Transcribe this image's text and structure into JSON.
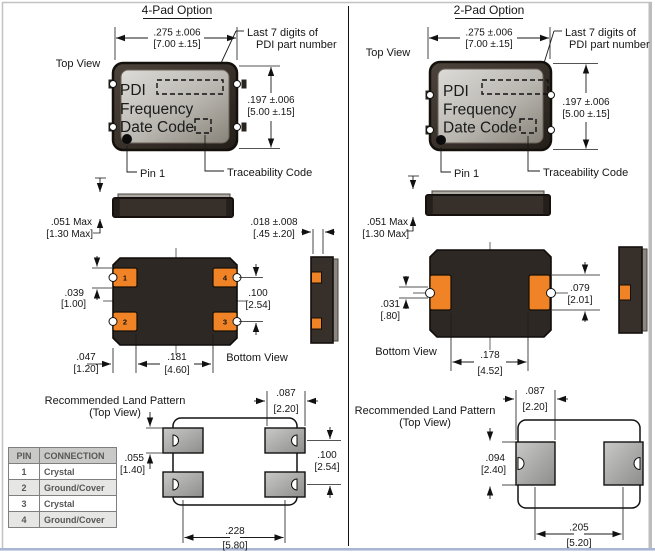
{
  "left": {
    "title": "4-Pad Option",
    "top_view_label": "Top View",
    "callout_line1": "Last 7 digits of",
    "callout_line2": "PDI part number",
    "package_text": {
      "line1": "PDI",
      "line2": "Frequency",
      "line3": "Date Code"
    },
    "pin1_label": "Pin 1",
    "traceability_label": "Traceability Code",
    "bottom_view_label": "Bottom View",
    "land_pattern_line1": "Recommended Land Pattern",
    "land_pattern_line2": "(Top View)",
    "pad_numbers": {
      "tl": "1",
      "tr": "4",
      "bl": "2",
      "br": "3"
    },
    "dims": {
      "width_in": ".275 ±.006",
      "width_mm": "[7.00 ±.15]",
      "height_in": ".197 ±.006",
      "height_mm": "[5.00 ±.15]",
      "thickness_in": ".051 Max",
      "thickness_mm": "[1.30 Max]",
      "pad_wrap_in": ".018 ±.008",
      "pad_wrap_mm": "[.45 ±.20]",
      "pad_height_in": ".039",
      "pad_height_mm": "[1.00]",
      "pad_pitch_in": ".100",
      "pad_pitch_mm": "[2.54]",
      "pad_edge_in": ".047",
      "pad_edge_mm": "[1.20]",
      "pad_span_in": ".181",
      "pad_span_mm": "[4.60]",
      "land_width_in": ".087",
      "land_width_mm": "[2.20]",
      "land_height_in": ".055",
      "land_height_mm": "[1.40]",
      "land_pitch_in": ".100",
      "land_pitch_mm": "[2.54]",
      "land_span_in": ".228",
      "land_span_mm": "[5.80]"
    }
  },
  "right": {
    "title": "2-Pad Option",
    "top_view_label": "Top View",
    "callout_line1": "Last 7 digits of",
    "callout_line2": "PDI part number",
    "package_text": {
      "line1": "PDI",
      "line2": "Frequency",
      "line3": "Date Code"
    },
    "pin1_label": "Pin 1",
    "traceability_label": "Traceability Code",
    "bottom_view_label": "Bottom View",
    "land_pattern_line1": "Recommended Land Pattern",
    "land_pattern_line2": "(Top View)",
    "dims": {
      "width_in": ".275 ±.006",
      "width_mm": "[7.00 ±.15]",
      "height_in": ".197 ±.006",
      "height_mm": "[5.00 ±.15]",
      "thickness_in": ".051 Max",
      "thickness_mm": "[1.30 Max]",
      "notch_in": ".031",
      "notch_mm": "[.80]",
      "pad_height_in": ".079",
      "pad_height_mm": "[2.01]",
      "pad_span_in": ".178",
      "pad_span_mm": "[4.52]",
      "land_width_in": ".087",
      "land_width_mm": "[2.20]",
      "land_height_in": ".094",
      "land_height_mm": "[2.40]",
      "land_span_in": ".205",
      "land_span_mm": "[5.20]"
    }
  },
  "pin_table": {
    "headers": [
      "PIN",
      "CONNECTION"
    ],
    "rows": [
      [
        "1",
        "Crystal"
      ],
      [
        "2",
        "Ground/Cover"
      ],
      [
        "3",
        "Crystal"
      ],
      [
        "4",
        "Ground/Cover"
      ]
    ]
  },
  "colors": {
    "pad_orange": "#ef8326",
    "body_dark": "#362f2a",
    "lid_light": "#d8d6d1",
    "land_gray": "#b5b5b3",
    "footer_blue": "#a9b6d3"
  }
}
